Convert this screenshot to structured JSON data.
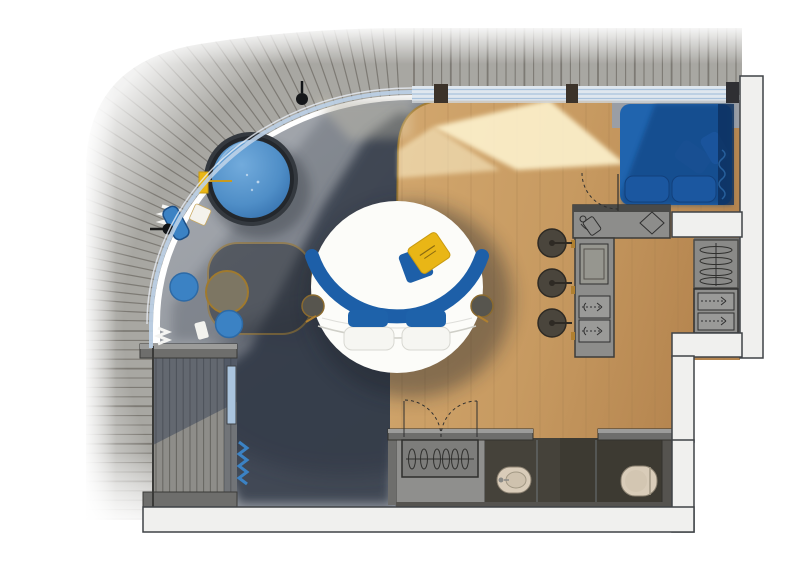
{
  "meta": {
    "title": "Hotel suite floor plan — top-down 3D render",
    "canvas": {
      "width": 800,
      "height": 562
    }
  },
  "palette": {
    "deck": "#a8a7a2",
    "deck_line": "#5a564f",
    "terrace": "#9a9ea5",
    "carpet": "#3a4250",
    "carpet_dark": "#2c3340",
    "wood": "#c99e66",
    "wood_dark": "#b98c55",
    "sun": "#fdf2cd",
    "wall": "#f0f0ee",
    "wall_edge": "#3f4246",
    "railing": "#bcd2e8",
    "glazing": "#dfe7ef",
    "water": "#4f8ec7",
    "water_deep": "#2f6aa8",
    "tub_rim": "#34393f",
    "sofa": "#2064ae",
    "sofa_dark": "#0f3e78",
    "bed_frame": "#1d5fa8",
    "pillow_blue": "#1e62aa",
    "pillow_yellow": "#e9b616",
    "mattress": "#fcfcf9",
    "counter": "#8d8d8b",
    "counter_edge": "#44443f",
    "stool": "#4a453c",
    "bath_floor": "#45423a",
    "fixture": "#d9ccb9",
    "gold": "#a07a2e",
    "glass": "#aac4de",
    "walkway": "#8e8d89",
    "wall_stub": "#6e6e6c",
    "table_olive": "#7d7663",
    "pouf": "#3b82c4",
    "shadow": "#1a202b"
  },
  "areas": {
    "deck": "Weathered wood deck",
    "terrace": "Concrete terrace",
    "bedroom": "Bedroom carpet area",
    "living": "Wooden floor living area",
    "kitchenette": "Kitchenette / vanity counter",
    "sofa_nook": "Sofa nook",
    "closet": "Built-in closet",
    "wardrobe": "Entry wardrobe",
    "bathroom": "Bathroom",
    "walkway": "Side entry walkway"
  },
  "furniture": {
    "hot_tub": "Round hot tub",
    "bed": "Round double bed",
    "bed_pillows": "2 blue + 2 white pillows",
    "deco_pillow": "Yellow branded throw pillow",
    "sofa": "Blue L-shaped sofa",
    "stools": "3 round stools",
    "side_table": "Round lounge table",
    "poufs": "2 blue poufs",
    "lounger": "Blue terrace lounger",
    "floor_lamps": "2 black pole lamps",
    "towels": "Folded white towels",
    "yellow_towel": "Yellow towel at tub edge",
    "bidet": "Bidet",
    "toilet": "Toilet",
    "wardrobe_hangers": "6 hangers on rail",
    "closet_hangers": "4 hangers on rail",
    "drawers": "Drawer units with pull symbols",
    "glass_door": "Glass sliding door",
    "double_door": "Double swing entry door",
    "interior_door": "Interior swing door"
  }
}
